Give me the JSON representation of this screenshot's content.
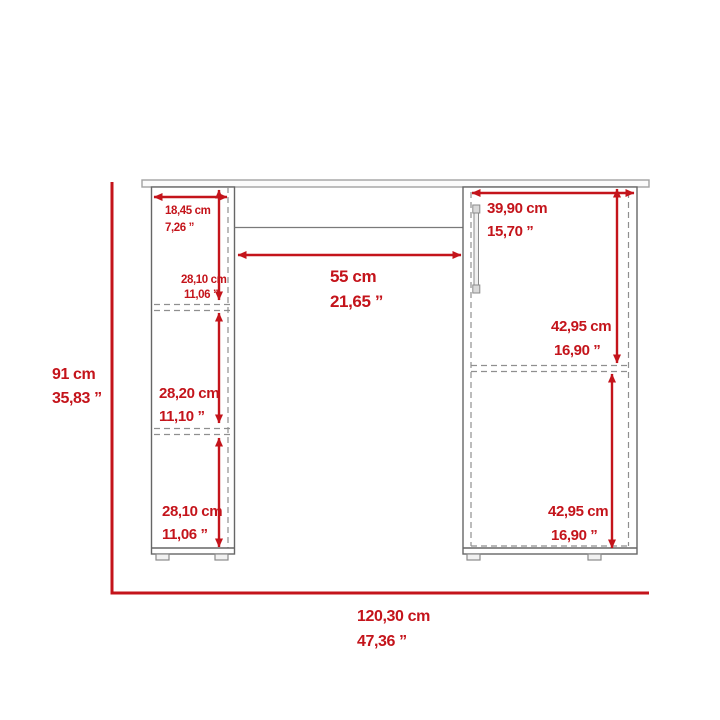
{
  "diagram": {
    "title": "desk-front-view-dimension-diagram",
    "colors": {
      "dimension_red": "#c4141b",
      "outline_gray": "#666666",
      "dashed_gray": "#8f8f8f",
      "desktop_gray": "#a2a2a2",
      "background": "#ffffff"
    },
    "dimensions": {
      "overall_height": {
        "cm": "91 cm",
        "in": "35,83 ”"
      },
      "overall_width": {
        "cm": "120,30 cm",
        "in": "47,36 ”"
      },
      "shelf_depth": {
        "cm": "18,45 cm",
        "in": "7,26 ”"
      },
      "shelf_top": {
        "cm": "28,10 cm",
        "in": "11,06 ”"
      },
      "shelf_middle": {
        "cm": "28,20 cm",
        "in": "11,10 ”"
      },
      "shelf_bottom": {
        "cm": "28,10 cm",
        "in": "11,06 ”"
      },
      "knee_space_width": {
        "cm": "55 cm",
        "in": "21,65 ”"
      },
      "cabinet_width": {
        "cm": "39,90 cm",
        "in": "15,70 ”"
      },
      "cabinet_upper": {
        "cm": "42,95 cm",
        "in": "16,90 ”"
      },
      "cabinet_lower": {
        "cm": "42,95 cm",
        "in": "16,90 ”"
      }
    }
  }
}
